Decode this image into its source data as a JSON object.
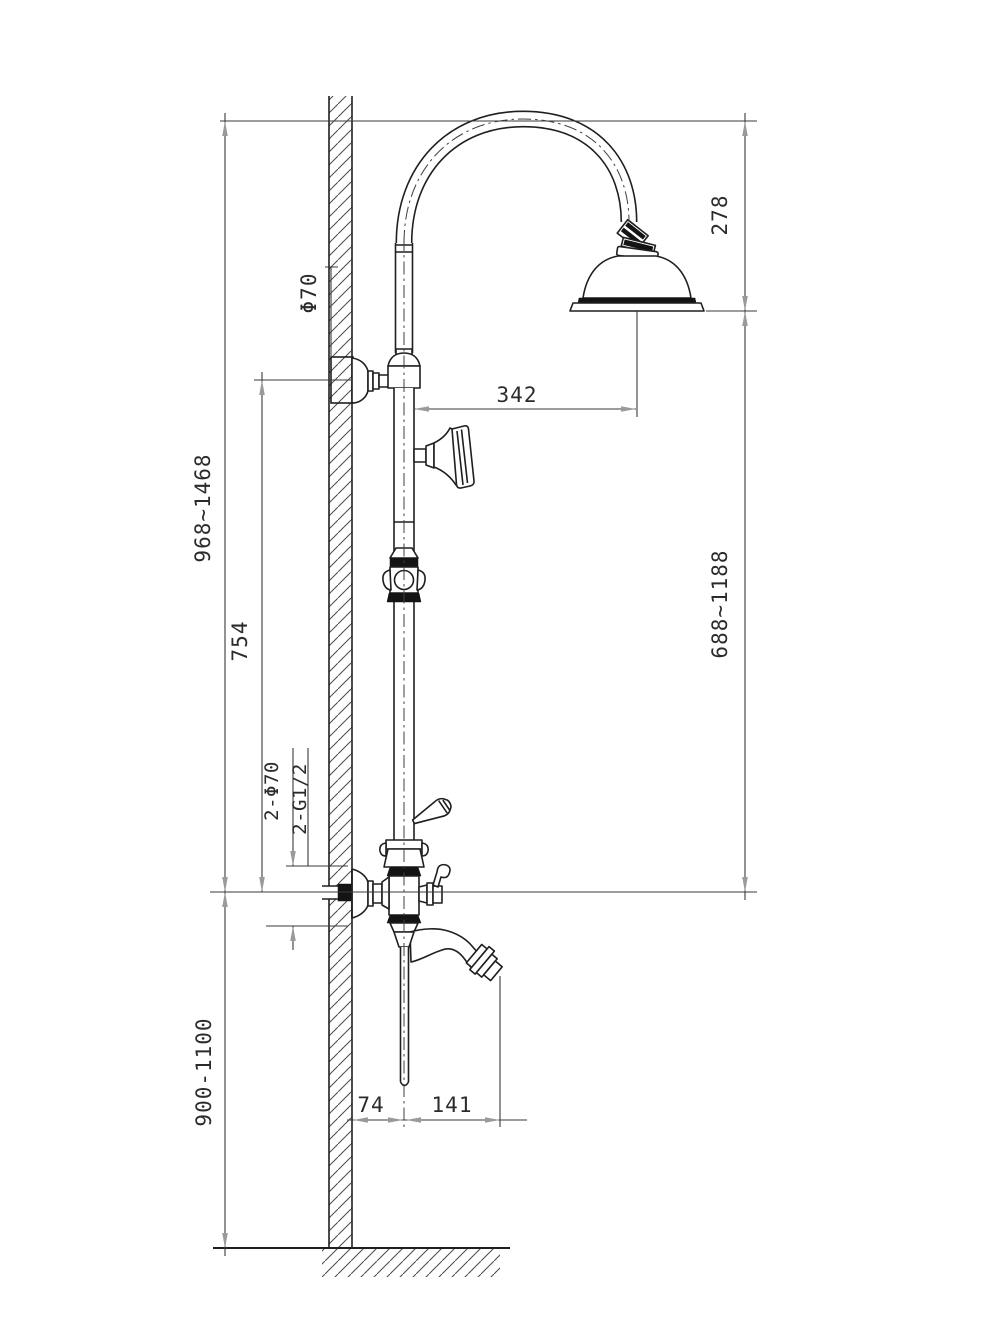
{
  "title": "Shower column installation dimension drawing",
  "colors": {
    "line": "#1f1f1f",
    "dimension_line": "#3a3a3a",
    "arrowhead": "#9a9a9a",
    "text": "#2b2b2b",
    "background": "#ffffff"
  },
  "dimensions": {
    "total_height_range": "968~1468",
    "bracket_to_mixer_height": "754",
    "top_escutcheon_diameter": "Φ70",
    "head_offset_from_column": "342",
    "head_drop_height": "278",
    "column_span_range": "688~1188",
    "inlet_escutcheons": "2-Φ70",
    "inlet_threads": "2-G1/2",
    "mixer_mount_height_range": "900-1100",
    "spout_wall_offset": "74",
    "spout_reach": "141"
  }
}
